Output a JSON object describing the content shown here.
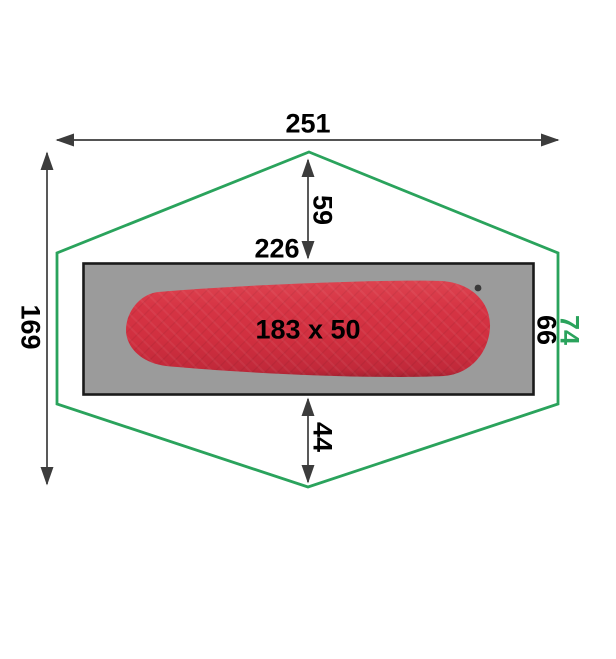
{
  "diagram": {
    "description": "Tent floor plan with sleeping mat, dimensions in cm",
    "labels": {
      "outer_width": "251",
      "outer_height": "169",
      "front_apex_depth": "59",
      "floor_width": "226",
      "floor_depth": "66",
      "side_length": "74",
      "rear_apex_depth": "44",
      "mat_size": "183 x 50"
    },
    "colors": {
      "outline": "#2aa35c",
      "floor": "#9b9b9b",
      "floor_border": "#1a1a1a",
      "mat": "#d02f3f",
      "dimension_line": "#3c3c3c",
      "label_text": "#000000"
    }
  }
}
